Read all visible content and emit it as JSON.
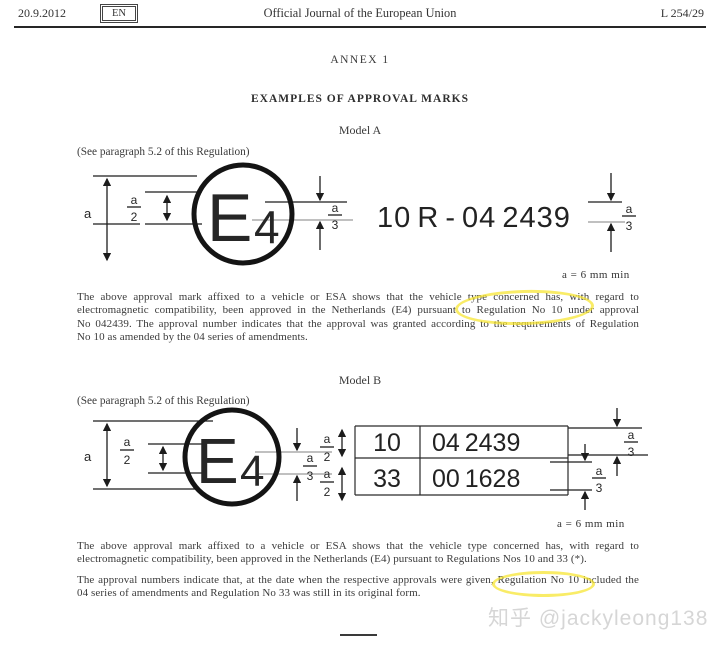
{
  "header": {
    "date": "20.9.2012",
    "language": "EN",
    "title": "Official Journal of the European Union",
    "page": "L 254/29"
  },
  "annex": {
    "title": "ANNEX 1",
    "heading": "EXAMPLES OF APPROVAL MARKS"
  },
  "model_a": {
    "label": "Model A",
    "see_note": "(See paragraph 5.2 of this Regulation)",
    "approval_code": "10 R - 04 2439",
    "size_note": "a = 6 mm min"
  },
  "model_b": {
    "label": "Model B",
    "see_note": "(See paragraph 5.2 of this Regulation)",
    "table": {
      "rows": [
        [
          "10",
          "04 2439"
        ],
        [
          "33",
          "00 1628"
        ]
      ]
    },
    "size_note": "a = 6 mm min"
  },
  "diagram_labels": {
    "e_letter": "E",
    "e_number": "4",
    "dim_a": "a",
    "num_a": "a",
    "den_2": "2",
    "den_3": "3"
  },
  "paragraphs": {
    "model_a_lines": [
      "The above approval mark affixed to a vehicle or ESA shows that the vehicle type concerned has, with regard to",
      "electromagnetic compatibility, been approved in the Netherlands (E4) pursuant to Regulation No 10 under approval",
      "No 042439. The approval number indicates that the approval was granted according to the requirements of Regulation",
      "No 10 as amended by the 04 series of amendments."
    ],
    "model_b_p1_lines": [
      "The above approval mark affixed to a vehicle or ESA shows that the vehicle type concerned has, with regard to",
      "electromagnetic compatibility, been approved in the Netherlands (E4) pursuant to Regulations Nos 10 and 33 (*)."
    ],
    "model_b_p2_lines": [
      "The approval numbers indicate that, at the date when the respective approvals were given, Regulation No 10 included the",
      "04 series of amendments and Regulation No 33 was still in its original form."
    ]
  },
  "highlight_color": "#f6e42d",
  "watermark": "知乎 @jackyleong138"
}
